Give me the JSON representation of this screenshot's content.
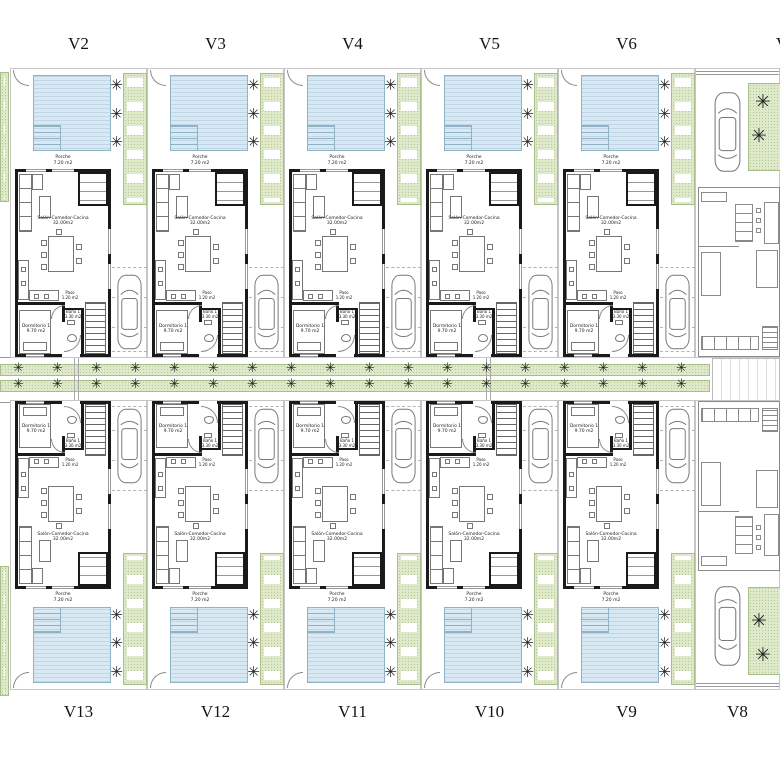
{
  "plan": {
    "type": "residential-site-floor-plan",
    "units_top": [
      {
        "label": "V2"
      },
      {
        "label": "V3"
      },
      {
        "label": "V4"
      },
      {
        "label": "V5"
      },
      {
        "label": "V6"
      }
    ],
    "units_bottom": [
      {
        "label": "V13"
      },
      {
        "label": "V12"
      },
      {
        "label": "V11"
      },
      {
        "label": "V10"
      },
      {
        "label": "V9"
      }
    ],
    "unit_top_right_partial": {
      "label": "V"
    },
    "unit_bottom_right": {
      "label": "V8"
    }
  },
  "rooms": {
    "salon": {
      "name": "Salón-Comedor-Cocina",
      "area": "32.00m2"
    },
    "dormitorio": {
      "name": "Dormitorio 1",
      "area": "9.70 m2"
    },
    "bano": {
      "name": "Baño 1",
      "area": "3.30 m2"
    },
    "paso": {
      "name": "Paso",
      "area": "1.20 m2"
    },
    "porche": {
      "name": "Porche",
      "area": "7.20 m2"
    }
  },
  "street": {
    "tree_rows": 2,
    "trees_per_row": 18
  },
  "glyphs": {
    "tree": "✳"
  },
  "colors": {
    "pool": "#d9e9f3",
    "pool_border": "#8fb2c4",
    "green": "#dde9c9",
    "green_dot": "#b5c897",
    "wall": "#1a1a1a",
    "tree": "#222222"
  }
}
